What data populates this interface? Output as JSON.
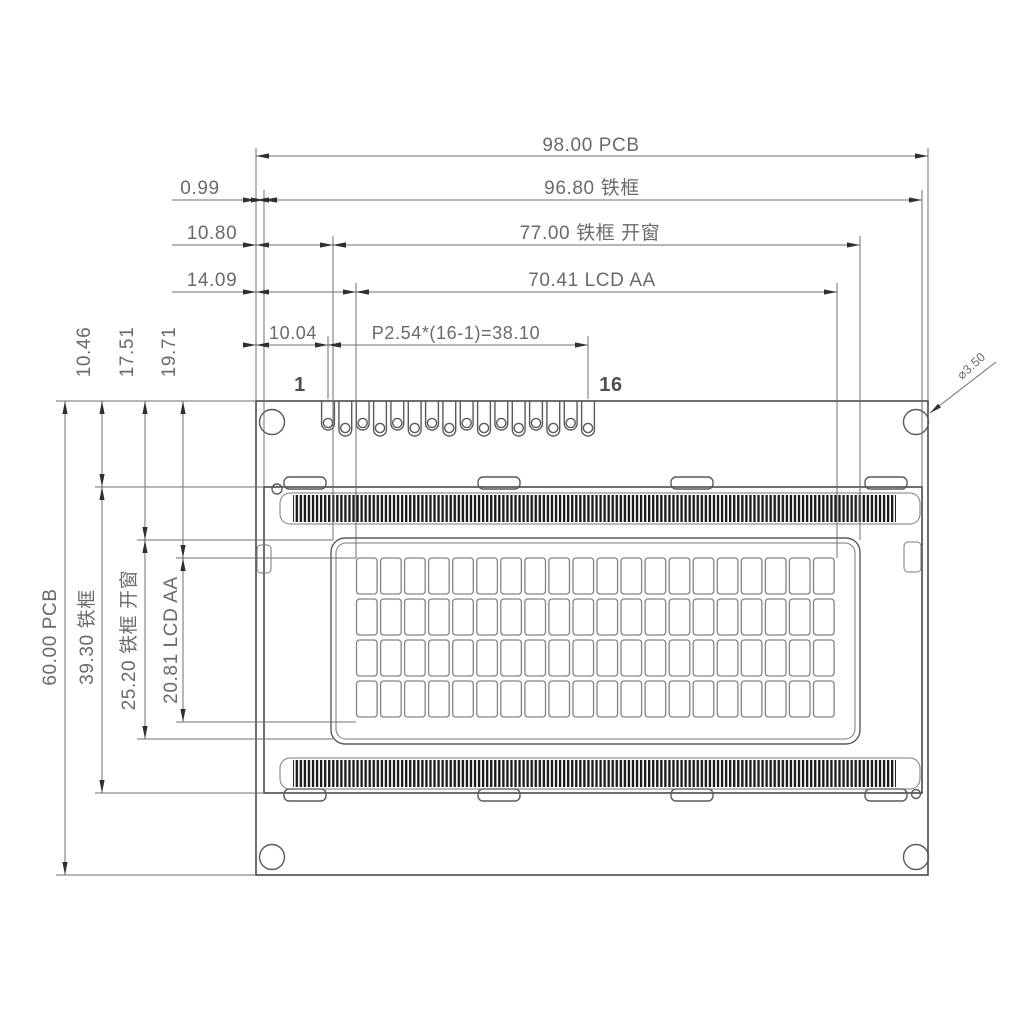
{
  "dims_horizontal": {
    "pcb_width": "98.00  PCB",
    "frame_width": "96.80  铁框",
    "frame_offset": "0.99",
    "window_width": "77.00  铁框  开窗",
    "window_offset": "10.80",
    "aa_width": "70.41  LCD  AA",
    "aa_offset": "14.09",
    "pin_pitch": "P2.54*(16-1)=38.10",
    "pin_offset": "10.04"
  },
  "dims_vertical": {
    "pcb_height": "60.00  PCB",
    "frame_height": "39.30  铁框",
    "window_height": "25.20  铁框  开窗",
    "aa_height": "20.81  LCD  AA",
    "frame_top_offset": "10.46",
    "window_top_offset": "17.51",
    "aa_top_offset": "19.71"
  },
  "annotations": {
    "hole_diameter": "⌀3.50",
    "pin_first": "1",
    "pin_last": "16"
  },
  "structure": {
    "pin_count": 16,
    "char_columns": 20,
    "char_rows": 4,
    "mounting_hole_count": 4,
    "bezel_tab_count": 4
  },
  "colors": {
    "line": "#4a4a4a",
    "dim_line": "#6f6f6f",
    "text": "#6a6a6a",
    "hatch": "#1c1c1c",
    "background": "#ffffff"
  }
}
